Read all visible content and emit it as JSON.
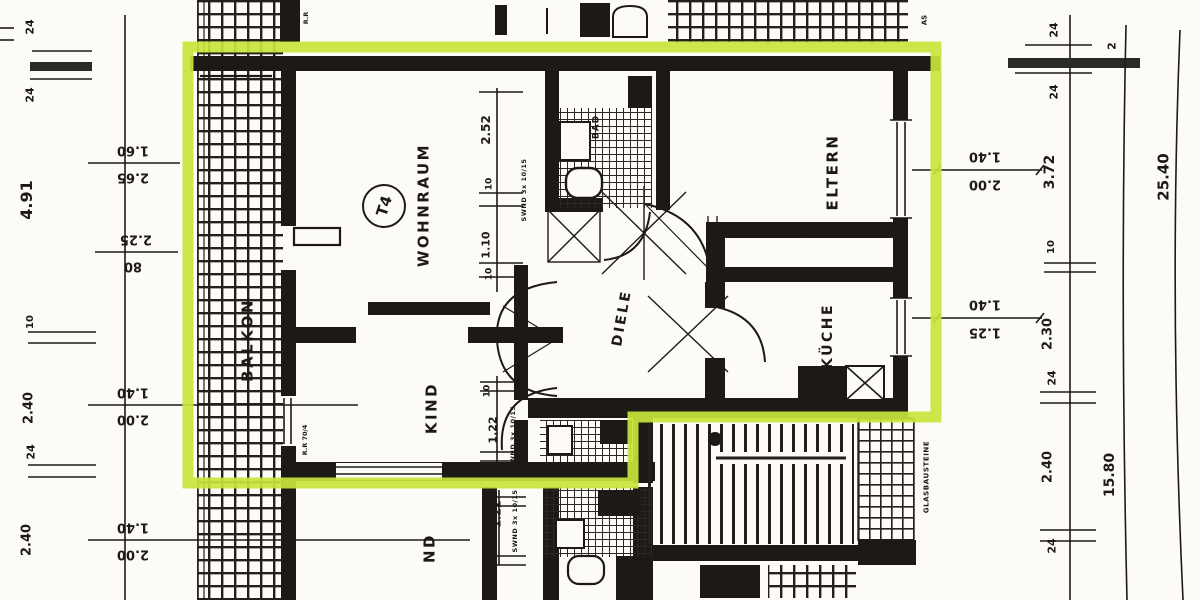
{
  "palette": {
    "highlight": "#c7e53b",
    "ink": "#1d1a16",
    "paper": "#fcfbf7"
  },
  "unit": {
    "badge": "T4"
  },
  "rooms": {
    "balkon": "BALKON",
    "wohnraum": "WOHNRAUM",
    "kind": "KIND",
    "diele": "DIELE",
    "bad": "BAD",
    "eltern": "ELTERN",
    "kueche": "KÜCHE",
    "kind_lower": "ND"
  },
  "notes": {
    "glass": "GLASBAUSTEINE",
    "rr": "R.R 70/4",
    "rr_top": "R.R",
    "as_top": "AS",
    "swnd_a": "SWND 3x 10/15",
    "swnd_b": "SWND 3x 10/15",
    "swnd_c": "SWND 3x 10/15"
  },
  "dims": {
    "left_chain": [
      "24",
      "24",
      "4.91",
      "10",
      "2.40",
      "24",
      "2.40"
    ],
    "left_pairs": [
      {
        "above": "1.60",
        "below": "2.65"
      },
      {
        "above": "2.25",
        "below": "80"
      },
      {
        "above": "1.40",
        "below": "2.00"
      },
      {
        "above": "1.40",
        "below": "2.00"
      }
    ],
    "right_pairs": [
      {
        "above": "1.40",
        "below": "2.00"
      },
      {
        "above": "1.40",
        "below": "1.25"
      }
    ],
    "chain1": [
      "24",
      "24",
      "3.72",
      "10",
      "2.30",
      "24",
      "2.40",
      "24"
    ],
    "chain2_top": "2",
    "chain2_label": "15.80",
    "chain3_label": "25.40",
    "interior_wohnraum": [
      "2.52",
      "10",
      "1.10",
      "10"
    ],
    "interior_kind": [
      "10",
      "1.22"
    ],
    "interior_kind_lower": [
      "1.22",
      "10"
    ],
    "eltern_door": [
      "10",
      "3.30"
    ]
  }
}
